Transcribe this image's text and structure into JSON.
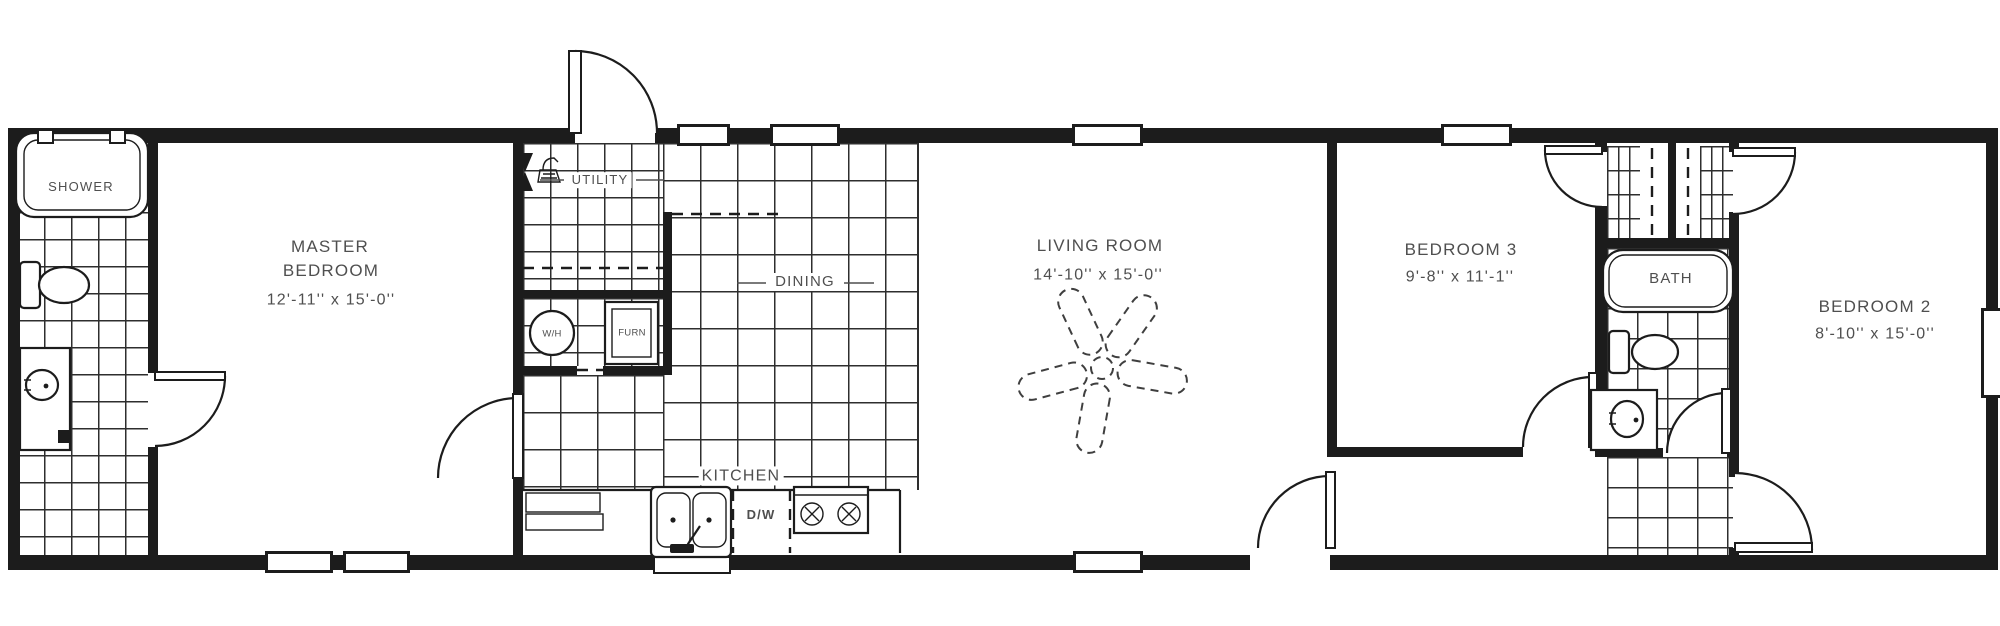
{
  "labels": {
    "shower": "SHOWER",
    "master_bedroom": {
      "name_line1": "MASTER",
      "name_line2": "BEDROOM",
      "dims": "12'-11'' x 15'-0''"
    },
    "utility": "UTILITY",
    "water_heater": "W/H",
    "furnace": "FURN",
    "dining": "DINING",
    "kitchen": "KITCHEN",
    "dishwasher": "D/W",
    "living_room": {
      "name": "LIVING ROOM",
      "dims": "14'-10'' x 15'-0''"
    },
    "bedroom3": {
      "name": "BEDROOM 3",
      "dims": "9'-8'' x 11'-1''"
    },
    "bath": "BATH",
    "bedroom2": {
      "name": "BEDROOM 2",
      "dims": "8'-10'' x 15'-0''"
    }
  },
  "colors": {
    "wall": "#1c1c1c",
    "label_text": "#4f4f4f",
    "tile_line": "#2e2e2e",
    "background": "#ffffff"
  }
}
